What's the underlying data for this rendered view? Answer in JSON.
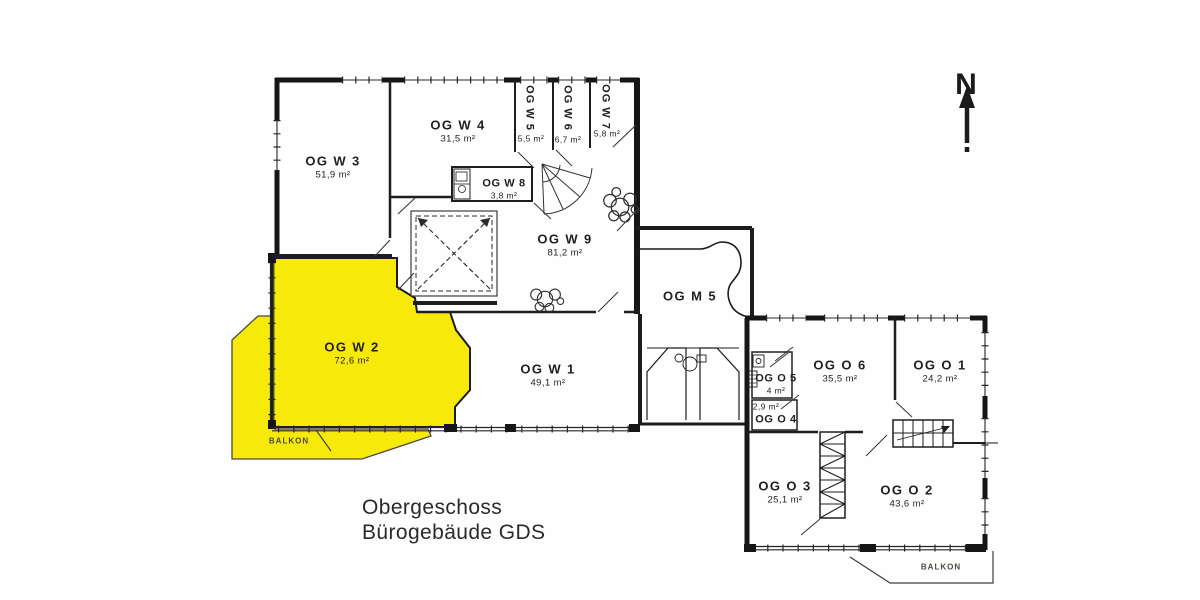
{
  "document": {
    "title_line1": "Obergeschoss",
    "title_line2": "Bürogebäude GDS"
  },
  "compass": {
    "north_label": "N"
  },
  "colors": {
    "highlight_yellow": "#F7EA0A",
    "wall_ink": "#1c1c1c"
  },
  "balconies": {
    "west_label": "BALKON",
    "east_label": "BALKON"
  },
  "rooms": [
    {
      "name": "OG W 3",
      "area": "51,9 m²"
    },
    {
      "name": "OG W 4",
      "area": "31,5 m²"
    },
    {
      "name": "OG W 5",
      "area": "5,5 m²"
    },
    {
      "name": "OG W 6",
      "area": "6,7 m²"
    },
    {
      "name": "OG W 7",
      "area": "5,8 m²"
    },
    {
      "name": "OG W 8",
      "area": "3,8 m²"
    },
    {
      "name": "OG W 9",
      "area": "81,2 m²"
    },
    {
      "name": "OG W 2",
      "area": "72,6 m²",
      "highlighted": true
    },
    {
      "name": "OG W 1",
      "area": "49,1 m²"
    },
    {
      "name": "OG M 5",
      "area": ""
    },
    {
      "name": "OG O 5",
      "area": "4 m²"
    },
    {
      "name": "OG O 4",
      "area": "2,9 m²"
    },
    {
      "name": "OG O 6",
      "area": "35,5 m²"
    },
    {
      "name": "OG O 1",
      "area": "24,2 m²"
    },
    {
      "name": "OG O 3",
      "area": "25,1 m²"
    },
    {
      "name": "OG O 2",
      "area": "43,6 m²"
    }
  ]
}
